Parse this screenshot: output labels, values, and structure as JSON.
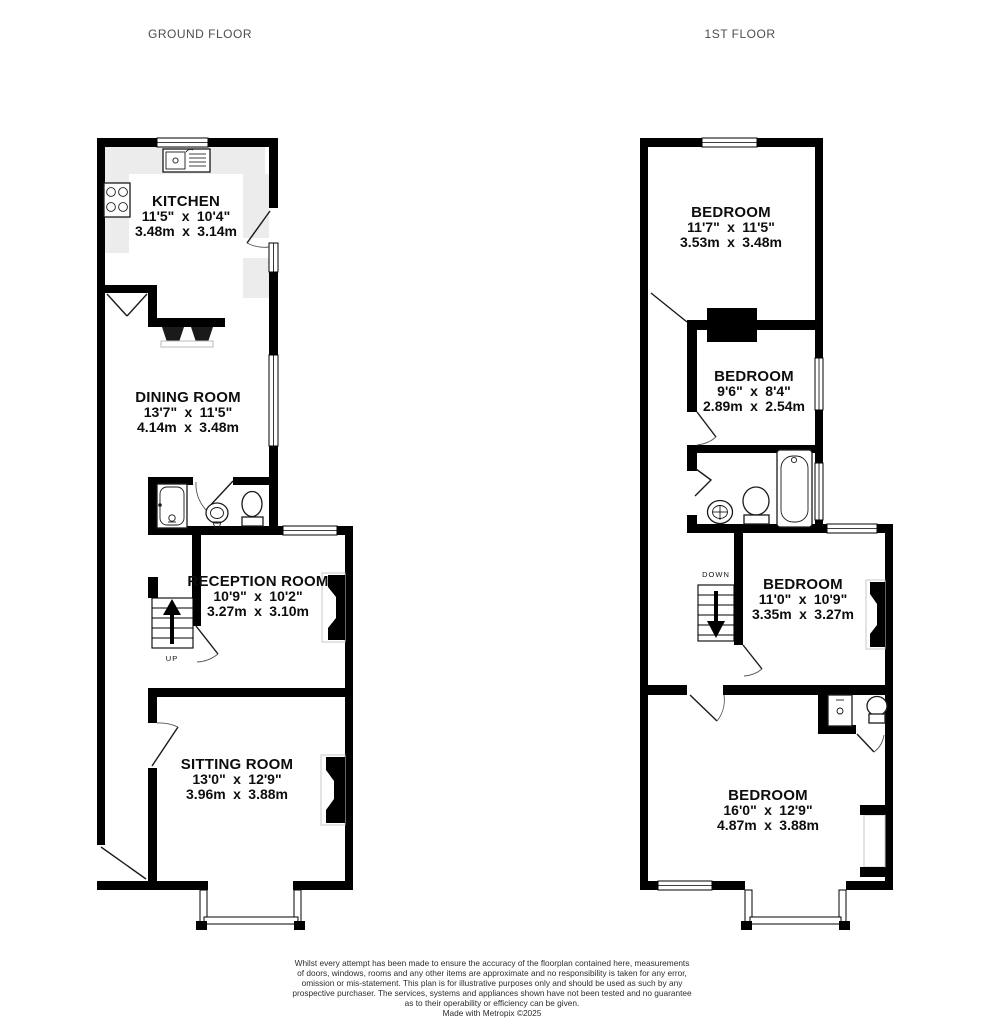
{
  "colors": {
    "wall": "#000000",
    "counter": "#ececec",
    "label_text": "#0d0d0d",
    "title_text": "#4d4d4d",
    "disclaimer_text": "#2d2d2d",
    "background": "#ffffff"
  },
  "floors": {
    "ground": {
      "title": "GROUND FLOOR",
      "stairs_label": "UP",
      "rooms": {
        "kitchen": {
          "name": "KITCHEN",
          "imperial": "11'5\" x 10'4\"",
          "metric": "3.48m x 3.14m"
        },
        "dining": {
          "name": "DINING ROOM",
          "imperial": "13'7\" x 11'5\"",
          "metric": "4.14m x 3.48m"
        },
        "reception": {
          "name": "RECEPTION ROOM",
          "imperial": "10'9\" x 10'2\"",
          "metric": "3.27m x 3.10m"
        },
        "sitting": {
          "name": "SITTING ROOM",
          "imperial": "13'0\" x 12'9\"",
          "metric": "3.96m x 3.88m"
        }
      }
    },
    "first": {
      "title": "1ST FLOOR",
      "stairs_label": "DOWN",
      "rooms": {
        "bedroom1": {
          "name": "BEDROOM",
          "imperial": "11'7\" x 11'5\"",
          "metric": "3.53m x 3.48m"
        },
        "bedroom2": {
          "name": "BEDROOM",
          "imperial": "9'6\" x 8'4\"",
          "metric": "2.89m x 2.54m"
        },
        "bedroom3": {
          "name": "BEDROOM",
          "imperial": "11'0\" x 10'9\"",
          "metric": "3.35m x 3.27m"
        },
        "bedroom4": {
          "name": "BEDROOM",
          "imperial": "16'0\" x 12'9\"",
          "metric": "4.87m x 3.88m"
        }
      }
    }
  },
  "disclaimer": {
    "lines": [
      "Whilst every attempt has been made to ensure the accuracy of the floorplan contained here, measurements",
      "of doors, windows, rooms and any other items are approximate and no responsibility is taken for any error,",
      "omission or mis-statement. This plan is for illustrative purposes only and should be used as such by any",
      "prospective purchaser. The services, systems and appliances shown have not been tested and no guarantee",
      "as to their operability or efficiency can be given."
    ],
    "credit": "Made with Metropix ©2025"
  }
}
